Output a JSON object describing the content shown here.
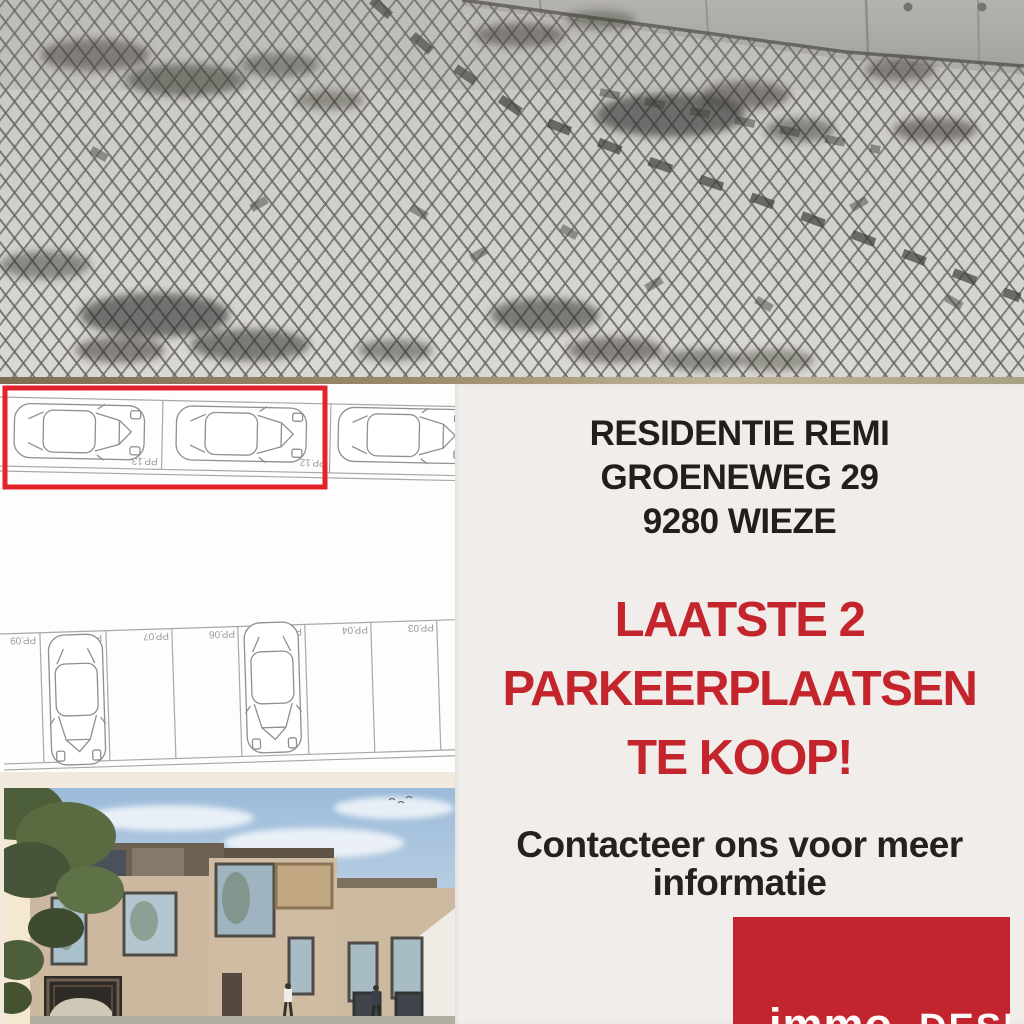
{
  "poster": {
    "address": [
      "RESIDENTIE REMI",
      "GROENEWEG 29",
      "9280 WIEZE"
    ],
    "headline": [
      "LAATSTE 2",
      "PARKEERPLAATSEN",
      "TE KOOP!"
    ],
    "cta": [
      "Contacteer ons voor meer",
      "informatie"
    ],
    "logo": {
      "word1": "immo",
      "word2": "DESK"
    }
  },
  "floorplan": {
    "row1_labels": [
      "PP.13",
      "PP.12"
    ],
    "row2_labels": [
      "PP.09",
      "PP.08",
      "PP.07",
      "PP.06",
      "PP.05",
      "PP.04",
      "PP.03"
    ]
  },
  "colors": {
    "background": "#F1EDEA",
    "accent_red": "#C4252C",
    "logo_red": "#C3252E",
    "highlight_red": "#E3232B",
    "text_black": "#231D1E"
  }
}
